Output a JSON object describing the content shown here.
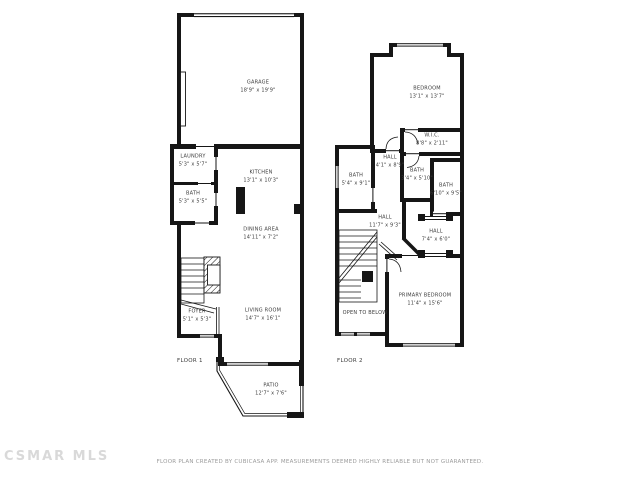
{
  "floors": [
    {
      "label": "FLOOR 1",
      "rooms": [
        {
          "name": "GARAGE",
          "dims": "18'9\" x 19'9\""
        },
        {
          "name": "LAUNDRY",
          "dims": "5'3\" x 5'7\""
        },
        {
          "name": "BATH",
          "dims": "5'3\" x 5'5\""
        },
        {
          "name": "KITCHEN",
          "dims": "13'1\" x 10'3\""
        },
        {
          "name": "DINING AREA",
          "dims": "14'11\" x 7'2\""
        },
        {
          "name": "FOYER",
          "dims": "5'1\" x 5'3\""
        },
        {
          "name": "LIVING ROOM",
          "dims": "14'7\" x 16'1\""
        },
        {
          "name": "PATIO",
          "dims": "12'7\" x 7'6\""
        }
      ]
    },
    {
      "label": "FLOOR 2",
      "rooms": [
        {
          "name": "BEDROOM",
          "dims": "13'1\" x 13'7\""
        },
        {
          "name": "W.I.C.",
          "dims": "8'8\" x 2'11\""
        },
        {
          "name": "BATH",
          "dims": "5'4\" x 9'1\""
        },
        {
          "name": "HALL",
          "dims": "4'1\" x 8'9\""
        },
        {
          "name": "BATH",
          "dims": "3'4\" x 5'10\""
        },
        {
          "name": "BATH",
          "dims": "6'10\" x 9'5\""
        },
        {
          "name": "HALL",
          "dims": "11'7\" x 9'3\""
        },
        {
          "name": "HALL",
          "dims": "7'4\" x 6'0\""
        },
        {
          "name": "PRIMARY BEDROOM",
          "dims": "11'4\" x 15'6\""
        },
        {
          "name": "OPEN TO BELOW",
          "dims": ""
        }
      ]
    }
  ],
  "footer": {
    "watermark": "CSMAR MLS",
    "disclaimer": "FLOOR PLAN CREATED BY CUBICASA APP. MEASUREMENTS DEEMED HIGHLY RELIABLE BUT NOT GUARANTEED."
  },
  "colors": {
    "wall": "#161616",
    "label": "#3c3c3c",
    "footer": "#9b9b9b",
    "watermark": "#d9d9d9"
  }
}
